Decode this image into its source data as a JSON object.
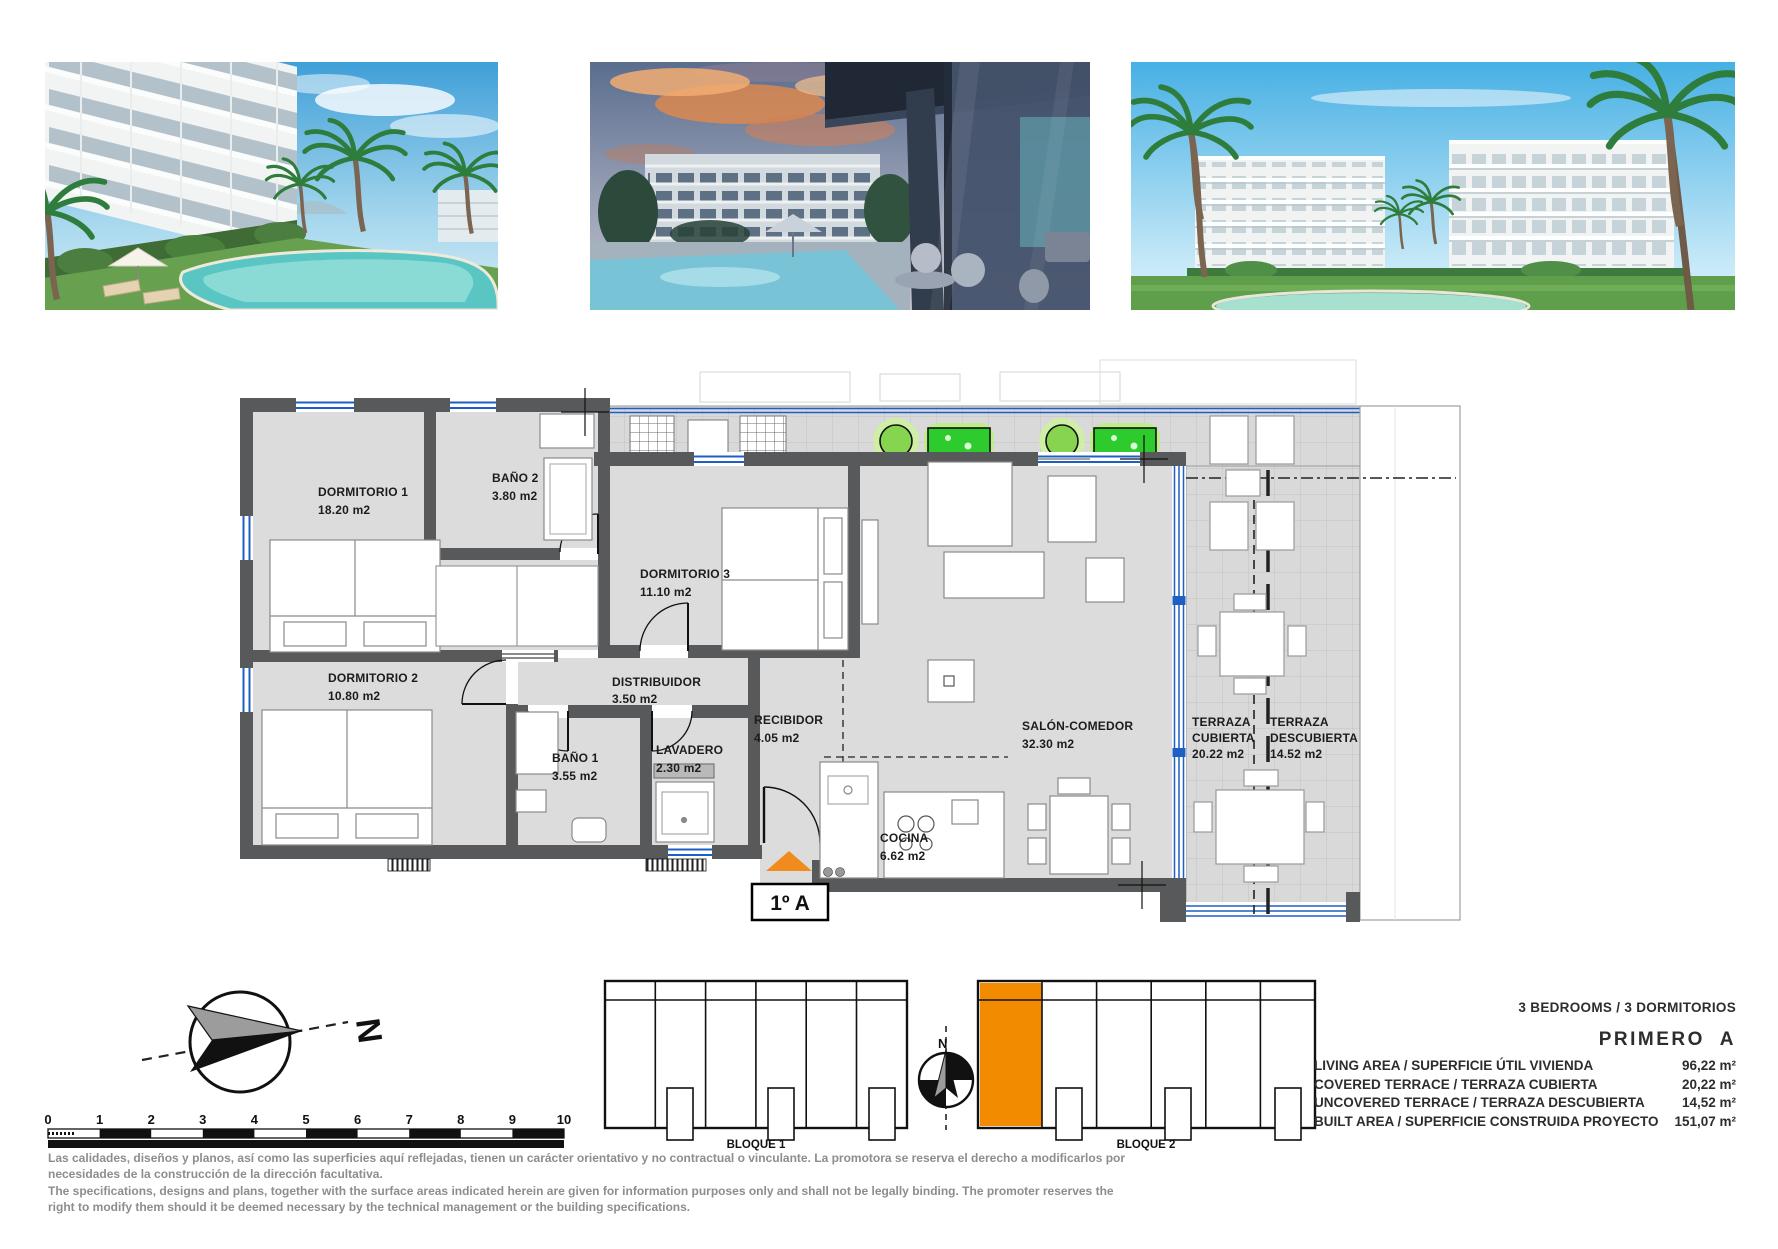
{
  "photos": [
    {
      "alt": "pool and garden render"
    },
    {
      "alt": "terrace at dusk render"
    },
    {
      "alt": "buildings and pool render"
    }
  ],
  "floor_plan": {
    "unit_box_label": "1º A",
    "rooms": {
      "dormitorio1": {
        "label": "DORMITORIO 1",
        "area": "18.20 m2"
      },
      "bano2": {
        "label": "BAÑO 2",
        "area": "3.80 m2"
      },
      "dormitorio3": {
        "label": "DORMITORIO 3",
        "area": "11.10 m2"
      },
      "dormitorio2": {
        "label": "DORMITORIO 2",
        "area": "10.80 m2"
      },
      "distribuidor": {
        "label": "DISTRIBUIDOR",
        "area": "3.50 m2"
      },
      "bano1": {
        "label": "BAÑO 1",
        "area": "3.55 m2"
      },
      "lavadero": {
        "label": "LAVADERO",
        "area": "2.30 m2"
      },
      "recibidor": {
        "label": "RECIBIDOR",
        "area": "4.05 m2"
      },
      "cocina": {
        "label": "COCINA",
        "area": "6.62 m2"
      },
      "salon": {
        "label": "SALÓN-COMEDOR",
        "area": "32.30 m2"
      },
      "terrazaCubierta": {
        "label1": "TERRAZA",
        "label2": "CUBIERTA",
        "area": "20.22 m2"
      },
      "terrazaDescubierta": {
        "label1": "TERRAZA",
        "label2": "DESCUBIERTA",
        "area": "14.52 m2"
      }
    }
  },
  "site": {
    "bloque1": "BLOQUE 1",
    "bloque2": "BLOQUE 2",
    "north": "N"
  },
  "scale": {
    "ticks": [
      "0",
      "1",
      "2",
      "3",
      "4",
      "5",
      "6",
      "7",
      "8",
      "9",
      "10"
    ]
  },
  "specs": {
    "bedrooms": "3 BEDROOMS / 3 DORMITORIOS",
    "unit": "PRIMERO  A",
    "rows": [
      {
        "label": "LIVING AREA / SUPERFICIE ÚTIL VIVIENDA",
        "value": "96,22 m²"
      },
      {
        "label": "COVERED TERRACE / TERRAZA CUBIERTA",
        "value": "20,22 m²"
      },
      {
        "label": "UNCOVERED TERRACE / TERRAZA DESCUBIERTA",
        "value": "14,52 m²"
      },
      {
        "label": "BUILT AREA / SUPERFICIE CONSTRUIDA PROYECTO",
        "value": "151,07 m²"
      }
    ]
  },
  "disclaimer": {
    "es1": "Las calidades, diseños y planos, así como las superficies aquí reflejadas, tienen un carácter orientativo y no contractual o vinculante. La promotora se reserva el derecho a modificarlos por",
    "es2": "necesidades de la construcción de la dirección facultativa.",
    "en1": "The specifications, designs and plans, together with the surface areas indicated herein are given for information purposes only and shall not be legally binding. The promoter reserves the",
    "en2": "right to modify them should it be deemed necessary by the technical management or the building specifications."
  },
  "colors": {
    "accent_orange": "#F28B00",
    "entrance_orange": "#F08C1E",
    "glass_blue": "#1E5FC4",
    "wall_gray": "#58595B",
    "floor_gray": "#DCDCDC",
    "plant_green": "#2ECB2E"
  }
}
